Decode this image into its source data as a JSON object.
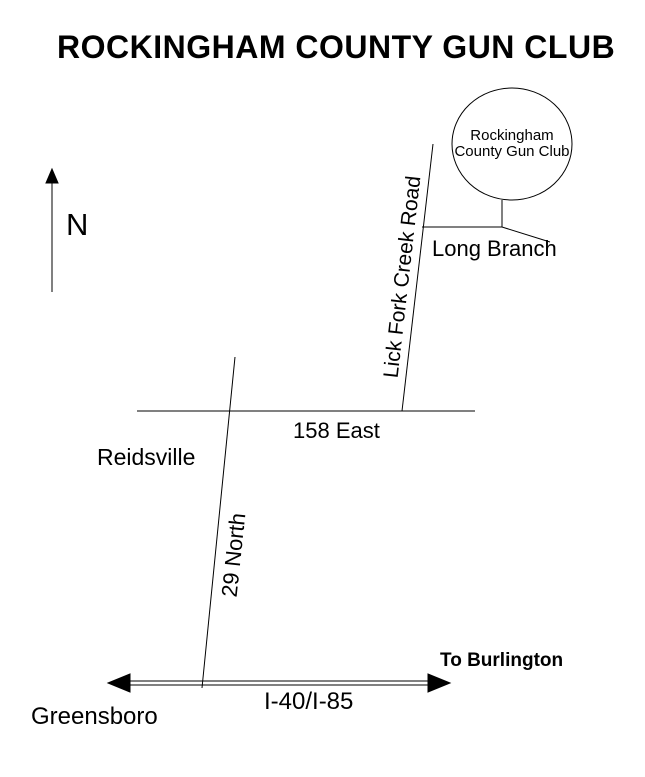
{
  "title": "ROCKINGHAM COUNTY GUN CLUB",
  "compass": {
    "label": "N"
  },
  "club": {
    "name_line1": "Rockingham",
    "name_line2": "County Gun Club"
  },
  "roads": {
    "lick_fork_creek": "Lick Fork Creek Road",
    "long_branch": "Long Branch",
    "route_158": "158 East",
    "route_29": "29 North",
    "interstate": "I-40/I-85"
  },
  "places": {
    "reidsville": "Reidsville",
    "greensboro": "Greensboro",
    "to_burlington": "To Burlington"
  },
  "colors": {
    "ink": "#000000",
    "background": "#ffffff"
  }
}
